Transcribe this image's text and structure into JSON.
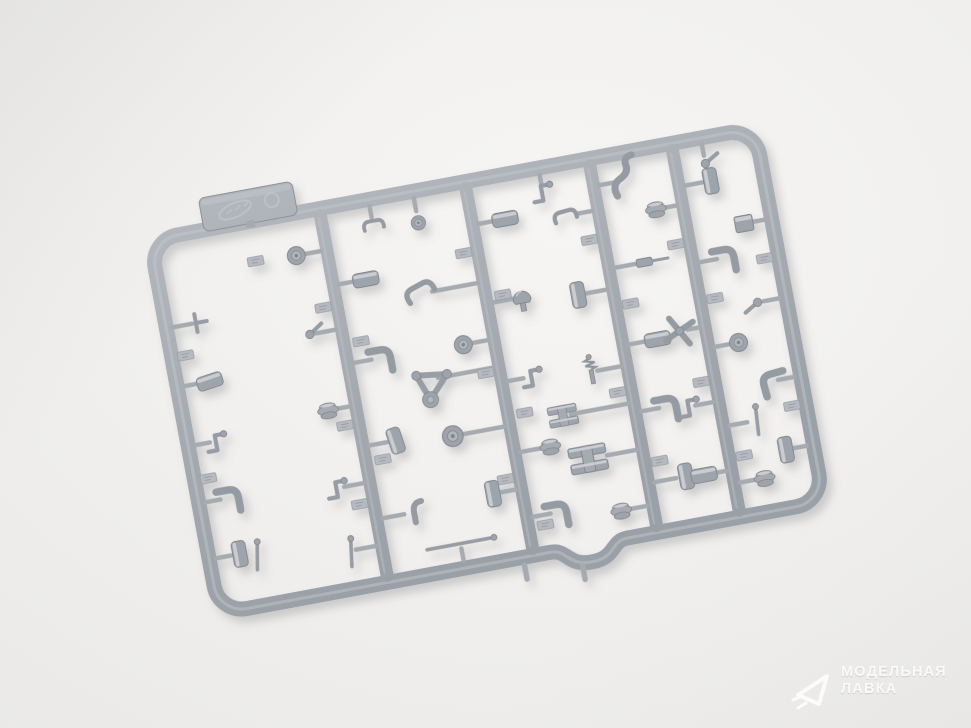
{
  "scene": {
    "description": "Photograph of a light gray injection-molded plastic model kit sprue (runner frame with many small mechanical detail parts) lying diagonally on a white studio background",
    "object": "model-kit-sprue",
    "sprue_tag": "embossed manufacturer marking (illegible)"
  },
  "colors": {
    "background": "#f1f0ee",
    "background_edge": "#eae9e7",
    "plastic": "#a5aab0",
    "plastic_dark": "#81878e",
    "plastic_light": "#c9cdd2",
    "shadow": "#808086",
    "watermark_text": "#ffffff"
  },
  "watermark": {
    "logo": "paper-plane-icon",
    "line1": "МОДЕЛЬНАЯ",
    "line2": "ЛАВКА"
  }
}
